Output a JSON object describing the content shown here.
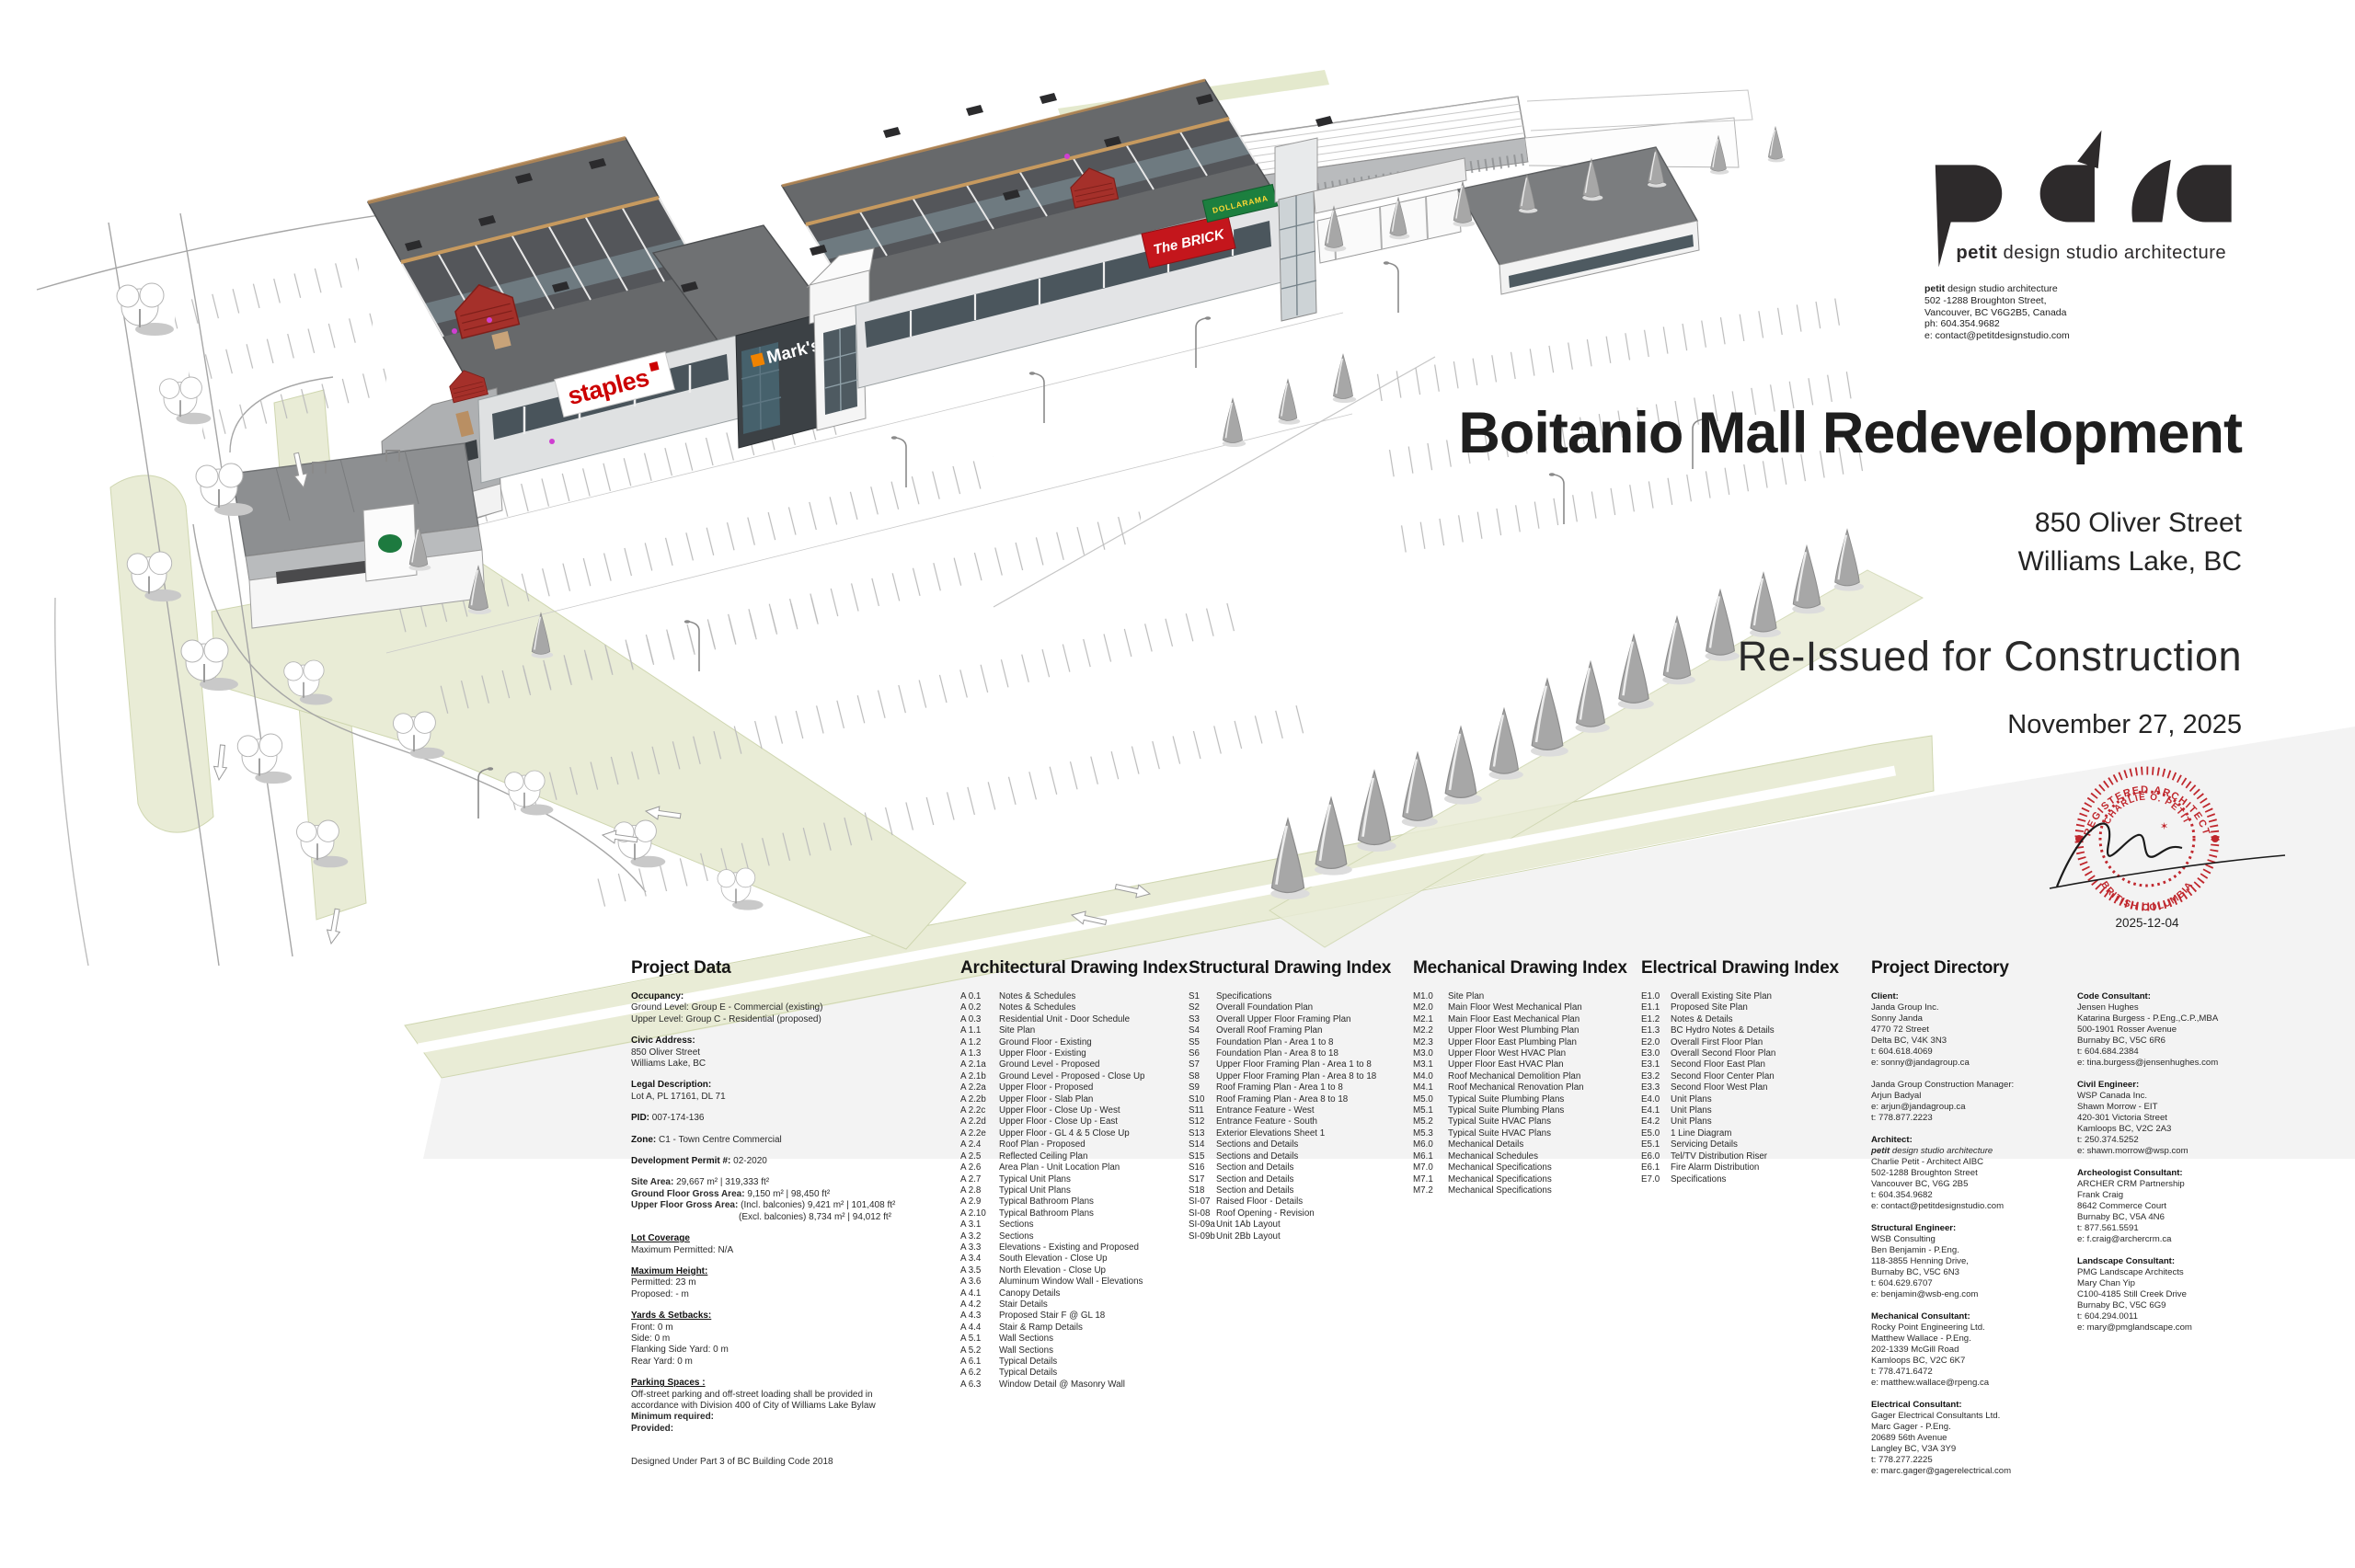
{
  "brand": {
    "logo": "pdsa",
    "tagline_bold": "petit",
    "tagline_rest": " design studio architecture",
    "address_first_bold": "petit",
    "address_first_rest": " design studio architecture",
    "address_lines": [
      "502 -1288 Broughton Street,",
      "Vancouver, BC V6G2B5, Canada",
      "ph: 604.354.9682",
      "e: contact@petitdesignstudio.com"
    ]
  },
  "title_block": {
    "title": "Boitanio Mall Redevelopment",
    "address_line1": "850 Oliver Street",
    "address_line2": "Williams Lake, BC",
    "status": "Re-Issued for Construction",
    "date": "November 27, 2025"
  },
  "stamp": {
    "top": "REGISTERED ARCHITECT",
    "name": "CHARLIE O. PETIT",
    "bottom": "BRITISH COLUMBIA",
    "date": "2025-12-04"
  },
  "signs": {
    "staples": "staples",
    "marks": "Mark's",
    "brick": "The BRICK",
    "dollarama": "DOLLARAMA"
  },
  "colors": {
    "stamp_red": "#c0272d",
    "staples_red": "#cc0001",
    "marks_orange": "#f08300",
    "brick_red": "#c4161c",
    "dollarama_green": "#1c7f3f",
    "landscape_green": "#e9ecd6",
    "roof_gray": "#67696b",
    "accent_red": "#a5302a"
  },
  "project_data": {
    "title": "Project Data",
    "blocks": [
      {
        "h": "Occupancy:",
        "lines": [
          "Ground Level: Group E - Commercial (existing)",
          "Upper Level: Group C - Residential (proposed)"
        ]
      },
      {
        "h": "Civic Address:",
        "lines": [
          "850 Oliver Street",
          "Williams Lake, BC"
        ]
      },
      {
        "h": "Legal Description:",
        "lines": [
          "Lot A, PL 17161, DL 71"
        ]
      },
      {
        "h": "PID:",
        "inline": "007-174-136"
      },
      {
        "h": "Zone:",
        "inline": "C1 - Town Centre Commercial"
      },
      {
        "h": "Development Permit #:",
        "inline": "02-2020"
      },
      {
        "kv": [
          {
            "k": "Site Area:",
            "v": "29,667 m²   |  319,333 ft²"
          },
          {
            "k": "Ground Floor Gross Area:",
            "v": "9,150 m²   |  98,450 ft²"
          },
          {
            "k": "Upper Floor Gross Area:",
            "v": "(Incl. balconies) 9,421 m²   |  101,408 ft²"
          },
          {
            "k": "",
            "v": "(Excl. balconies) 8,734 m²   |  94,012 ft²",
            "indent": 117
          }
        ]
      },
      {
        "h": "Lot Coverage",
        "u": true,
        "lines": [
          "Maximum Permitted: N/A"
        ]
      },
      {
        "h": "Maximum Height:",
        "u": true,
        "lines": [
          "Permitted: 23 m",
          "Proposed: - m"
        ]
      },
      {
        "h": "Yards & Setbacks:",
        "u": true,
        "lines": [
          "Front: 0 m",
          "Side: 0 m",
          "Flanking Side Yard: 0 m",
          "Rear Yard: 0 m"
        ]
      },
      {
        "h": "Parking Spaces :",
        "u": true,
        "lines": [
          "Off-street parking and off-street loading shall be provided in",
          "accordance with Division 400 of City of Williams Lake Bylaw"
        ],
        "bold_lines": [
          "Minimum required:",
          "Provided:"
        ]
      },
      {
        "lines": [
          "",
          "Designed Under Part 3 of BC Building Code 2018"
        ]
      }
    ]
  },
  "indexes": [
    {
      "title": "Architectural Drawing Index",
      "entries": [
        [
          "A 0.1",
          "Notes & Schedules"
        ],
        [
          "A 0.2",
          "Notes & Schedules"
        ],
        [
          "A 0.3",
          "Residential Unit - Door Schedule"
        ],
        [
          "A 1.1",
          "Site Plan"
        ],
        [
          "A 1.2",
          "Ground Floor - Existing"
        ],
        [
          "A 1.3",
          "Upper Floor - Existing"
        ],
        [
          "A 2.1a",
          "Ground Level - Proposed"
        ],
        [
          "A 2.1b",
          "Ground Level - Proposed - Close Up"
        ],
        [
          "A 2.2a",
          "Upper Floor - Proposed"
        ],
        [
          "A 2.2b",
          "Upper Floor - Slab Plan"
        ],
        [
          "A 2.2c",
          "Upper Floor - Close Up - West"
        ],
        [
          "A 2.2d",
          "Upper Floor - Close Up - East"
        ],
        [
          "A 2.2e",
          "Upper Floor - GL 4 & 5 Close Up"
        ],
        [
          "A 2.4",
          "Roof Plan - Proposed"
        ],
        [
          "A 2.5",
          "Reflected Ceiling Plan"
        ],
        [
          "A 2.6",
          "Area Plan - Unit Location Plan"
        ],
        [
          "A 2.7",
          "Typical Unit Plans"
        ],
        [
          "A 2.8",
          "Typical Unit Plans"
        ],
        [
          "A 2.9",
          "Typical Bathroom Plans"
        ],
        [
          "A 2.10",
          "Typical Bathroom Plans"
        ],
        [
          "A 3.1",
          "Sections"
        ],
        [
          "A 3.2",
          "Sections"
        ],
        [
          "A 3.3",
          "Elevations - Existing and Proposed"
        ],
        [
          "A 3.4",
          "South Elevation - Close Up"
        ],
        [
          "A 3.5",
          "North Elevation - Close Up"
        ],
        [
          "A 3.6",
          "Aluminum Window Wall - Elevations"
        ],
        [
          "A 4.1",
          "Canopy Details"
        ],
        [
          "A 4.2",
          "Stair Details"
        ],
        [
          "A 4.3",
          "Proposed Stair F @ GL 18"
        ],
        [
          "A 4.4",
          "Stair & Ramp Details"
        ],
        [
          "A 5.1",
          "Wall Sections"
        ],
        [
          "A 5.2",
          "Wall Sections"
        ],
        [
          "A 6.1",
          "Typical Details"
        ],
        [
          "A 6.2",
          "Typical Details"
        ],
        [
          "A 6.3",
          "Window Detail @ Masonry Wall"
        ]
      ]
    },
    {
      "title": "Structural Drawing Index",
      "entries": [
        [
          "S1",
          "Specifications"
        ],
        [
          "S2",
          "Overall Foundation Plan"
        ],
        [
          "S3",
          "Overall Upper Floor Framing Plan"
        ],
        [
          "S4",
          "Overall Roof Framing Plan"
        ],
        [
          "S5",
          "Foundation Plan - Area 1 to 8"
        ],
        [
          "S6",
          "Foundation Plan - Area 8 to 18"
        ],
        [
          "S7",
          "Upper Floor Framing Plan - Area 1 to 8"
        ],
        [
          "S8",
          "Upper Floor Framing Plan - Area 8 to 18"
        ],
        [
          "S9",
          "Roof Framing Plan - Area 1 to 8"
        ],
        [
          "S10",
          "Roof Framing Plan - Area 8 to 18"
        ],
        [
          "S11",
          "Entrance Feature - West"
        ],
        [
          "S12",
          "Entrance Feature - South"
        ],
        [
          "S13",
          "Exterior Elevations Sheet 1"
        ],
        [
          "S14",
          "Sections and Details"
        ],
        [
          "S15",
          "Sections and Details"
        ],
        [
          "S16",
          "Section and Details"
        ],
        [
          "S17",
          "Section and Details"
        ],
        [
          "S18",
          "Section and Details"
        ],
        [
          "SI-07",
          "Raised Floor - Details"
        ],
        [
          "SI-08",
          "Roof Opening - Revision"
        ],
        [
          "SI-09a",
          "Unit 1Ab Layout"
        ],
        [
          "SI-09b",
          "Unit 2Bb Layout"
        ]
      ]
    },
    {
      "title": "Mechanical Drawing Index",
      "entries": [
        [
          "M1.0",
          "Site Plan"
        ],
        [
          "M2.0",
          "Main Floor West Mechanical Plan"
        ],
        [
          "M2.1",
          "Main Floor East Mechanical Plan"
        ],
        [
          "M2.2",
          "Upper Floor West Plumbing Plan"
        ],
        [
          "M2.3",
          "Upper Floor East Plumbing Plan"
        ],
        [
          "M3.0",
          "Upper Floor West HVAC Plan"
        ],
        [
          "M3.1",
          "Upper Floor East HVAC Plan"
        ],
        [
          "M4.0",
          "Roof Mechanical Demolition Plan"
        ],
        [
          "M4.1",
          "Roof Mechanical Renovation Plan"
        ],
        [
          "M5.0",
          "Typical Suite Plumbing Plans"
        ],
        [
          "M5.1",
          "Typical Suite Plumbing Plans"
        ],
        [
          "M5.2",
          "Typical Suite HVAC Plans"
        ],
        [
          "M5.3",
          "Typical Suite HVAC Plans"
        ],
        [
          "M6.0",
          "Mechanical Details"
        ],
        [
          "M6.1",
          "Mechanical Schedules"
        ],
        [
          "M7.0",
          "Mechanical Specifications"
        ],
        [
          "M7.1",
          "Mechanical Specifications"
        ],
        [
          "M7.2",
          "Mechanical Specifications"
        ]
      ]
    },
    {
      "title": "Electrical Drawing Index",
      "entries": [
        [
          "E1.0",
          "Overall Existing Site Plan"
        ],
        [
          "E1.1",
          "Proposed Site Plan"
        ],
        [
          "E1.2",
          "Notes & Details"
        ],
        [
          "E1.3",
          "BC Hydro Notes & Details"
        ],
        [
          "E2.0",
          "Overall First Floor Plan"
        ],
        [
          "E3.0",
          "Overall Second Floor Plan"
        ],
        [
          "E3.1",
          "Second Floor East Plan"
        ],
        [
          "E3.2",
          "Second Floor Center Plan"
        ],
        [
          "E3.3",
          "Second Floor West Plan"
        ],
        [
          "E4.0",
          "Unit Plans"
        ],
        [
          "E4.1",
          "Unit Plans"
        ],
        [
          "E4.2",
          "Unit Plans"
        ],
        [
          "E5.0",
          "1 Line Diagram"
        ],
        [
          "E5.1",
          "Servicing Details"
        ],
        [
          "E6.0",
          "Tel/TV Distribution Riser"
        ],
        [
          "E6.1",
          "Fire Alarm Distribution"
        ],
        [
          "E7.0",
          "Specifications"
        ]
      ]
    }
  ],
  "directory": {
    "title": "Project Directory",
    "columns": [
      [
        {
          "role": "Client:",
          "lines": [
            "Janda Group Inc.",
            "Sonny Janda",
            "4770 72 Street",
            "Delta BC, V4K 3N3",
            "t: 604.618.4069",
            "e: sonny@jandagroup.ca"
          ]
        },
        {
          "role": "",
          "lines": [
            "Janda Group Construction Manager:",
            "Arjun Badyal",
            "e: arjun@jandagroup.ca",
            "t: 778.877.2223"
          ]
        },
        {
          "role": "Architect:",
          "pi": true,
          "lines": [
            "petit design studio architecture",
            "Charlie Petit - Architect AIBC",
            "502-1288 Broughton Street",
            "Vancouver BC, V6G 2B5",
            "t: 604.354.9682",
            "e: contact@petitdesignstudio.com"
          ]
        },
        {
          "role": "Structural Engineer:",
          "lines": [
            "WSB Consulting",
            "Ben Benjamin - P.Eng.",
            "118-3855 Henning Drive,",
            "Burnaby BC, V5C 6N3",
            "t: 604.629.6707",
            "e: benjamin@wsb-eng.com"
          ]
        },
        {
          "role": "Mechanical Consultant:",
          "lines": [
            "Rocky Point Engineering Ltd.",
            "Matthew Wallace - P.Eng.",
            "202-1339 McGill Road",
            "Kamloops BC, V2C 6K7",
            "t: 778.471.6472",
            "e: matthew.wallace@rpeng.ca"
          ]
        },
        {
          "role": "Electrical Consultant:",
          "lines": [
            "Gager Electrical Consultants Ltd.",
            "Marc Gager - P.Eng.",
            "20689 56th Avenue",
            "Langley BC, V3A 3Y9",
            "t: 778.277.2225",
            "e: marc.gager@gagerelectrical.com"
          ]
        }
      ],
      [
        {
          "role": "Code Consultant:",
          "lines": [
            "Jensen Hughes",
            "Katarina Burgess - P.Eng.,C.P.,MBA",
            "500-1901 Rosser Avenue",
            "Burnaby BC, V5C 6R6",
            "t: 604.684.2384",
            "e: tina.burgess@jensenhughes.com"
          ]
        },
        {
          "role": "Civil Engineer:",
          "lines": [
            "WSP Canada Inc.",
            "Shawn Morrow - EIT",
            "420-301 Victoria Street",
            "Kamloops BC, V2C 2A3",
            "t: 250.374.5252",
            "e: shawn.morrow@wsp.com"
          ]
        },
        {
          "role": "Archeologist Consultant:",
          "lines": [
            "ARCHER CRM Partnership",
            "Frank Craig",
            "8642 Commerce Court",
            "Burnaby BC, V5A 4N6",
            "t: 877.561.5591",
            "e: f.craig@archercrm.ca"
          ]
        },
        {
          "role": "Landscape Consultant:",
          "lines": [
            "PMG Landscape Architects",
            "Mary Chan Yip",
            "C100-4185 Still Creek Drive",
            "Burnaby BC, V5C 6G9",
            "t: 604.294.0011",
            "e: mary@pmglandscape.com"
          ]
        }
      ]
    ]
  }
}
